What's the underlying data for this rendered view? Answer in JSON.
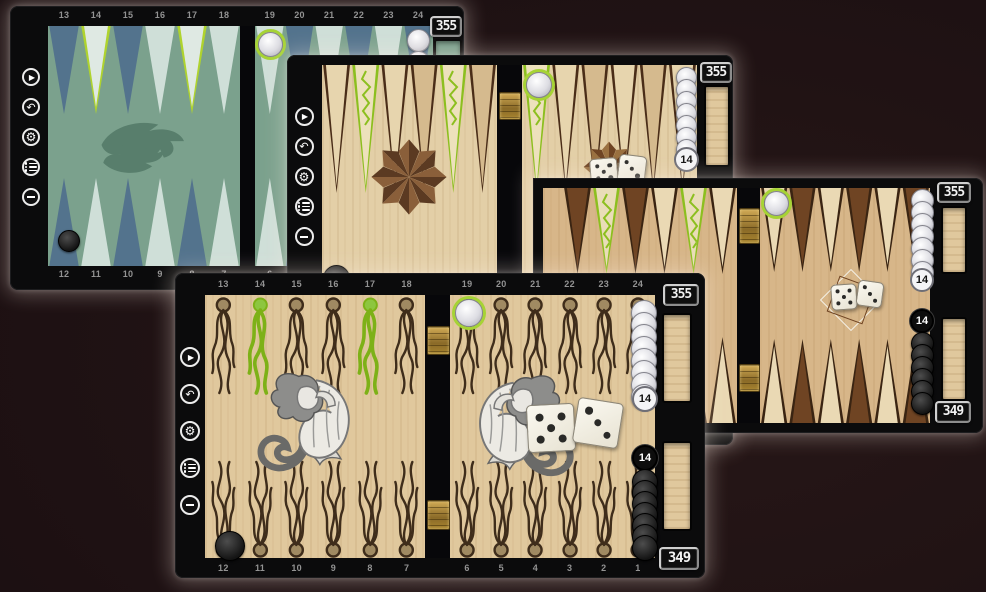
{
  "app": {
    "description": "backgammon game screenshots montage"
  },
  "sidebar_icons": [
    {
      "name": "play",
      "glyph": "▶"
    },
    {
      "name": "undo",
      "glyph": "↶"
    },
    {
      "name": "settings",
      "glyph": "⚙"
    },
    {
      "name": "menu",
      "glyph": "menu-list"
    },
    {
      "name": "boards",
      "glyph": "grid-squares"
    }
  ],
  "boards": {
    "dragon": {
      "theme_name": "dragon-teal-theme",
      "score_white": "355",
      "top_numbers_left": [
        "13",
        "14",
        "15",
        "16",
        "17",
        "18"
      ],
      "top_numbers_right": [
        "19",
        "20",
        "21",
        "22",
        "23",
        "24"
      ],
      "bottom_numbers_left": [
        "12",
        "11",
        "10",
        "9",
        "8",
        "7"
      ],
      "bottom_numbers_right": [
        "6",
        "5",
        "4",
        "3",
        "2",
        "1"
      ],
      "highlighted_points": [
        "14",
        "17"
      ],
      "checkers": {
        "white_on_24": 2,
        "white_ring_on_19": 1,
        "black_on_12": 1
      },
      "colors": {
        "field": "#7BA18D",
        "point_dark": "#53738D",
        "point_light": "#CFDFD8",
        "highlight": "#AFD32E",
        "highlight_fill": "#DFE9E3",
        "dragon": "#587E6C"
      }
    },
    "star": {
      "theme_name": "wood-compass-star-theme",
      "score_white": "355",
      "white_off_count": "14",
      "highlighted_points": [
        "14",
        "17",
        "19"
      ],
      "dice": [
        "5",
        "3"
      ],
      "checkers": {
        "white_stack_visible": 7,
        "white_ring_on_19": 1,
        "black_corner": 1
      },
      "colors": {
        "outline": "#4A2D18",
        "point_a": "#E7D5AE",
        "point_b": "#D5BA8E",
        "highlight": "#8CBF1F",
        "highlight_fill": "#EDE1BC",
        "star_dark": "#5B3A22",
        "star_mid": "#8A5F3A"
      }
    },
    "dice": {
      "theme_name": "wood-brown-points-theme",
      "score_white": "355",
      "score_black": "349",
      "white_off_count": "14",
      "black_off_count": "14",
      "dice": [
        "5",
        "3"
      ],
      "highlighted_points": [
        "14",
        "17"
      ],
      "checkers": {
        "white_stack_visible": 7,
        "black_stack_visible": 6,
        "white_ring_on_19": 1
      },
      "colors": {
        "outline": "#3A2412",
        "point_a": "#6F4423",
        "point_b": "#EAD9B4",
        "highlight": "#8CBF1F",
        "highlight_fill": "#E9DDB8"
      }
    },
    "mermaid": {
      "theme_name": "mermaid-seaweed-theme",
      "score_white": "355",
      "score_black": "349",
      "white_off_count": "14",
      "black_off_count": "14",
      "dice": [
        "5",
        "3"
      ],
      "top_numbers_left": [
        "13",
        "14",
        "15",
        "16",
        "17",
        "18"
      ],
      "top_numbers_right": [
        "19",
        "20",
        "21",
        "22",
        "23",
        "24"
      ],
      "bottom_numbers_left": [
        "12",
        "11",
        "10",
        "9",
        "8",
        "7"
      ],
      "bottom_numbers_right": [
        "6",
        "5",
        "4",
        "3",
        "2",
        "1"
      ],
      "highlighted_points": [
        "14",
        "17"
      ],
      "checkers": {
        "white_stack_visible": 8,
        "black_stack_visible": 7,
        "white_ring_on_19": 1,
        "black_on_12": 1
      },
      "colors": {
        "weed": "#3F2D1B",
        "weed_bulb": "#A08A62",
        "highlight": "#7DB117",
        "highlight_bulb": "#8DC63F"
      }
    }
  }
}
